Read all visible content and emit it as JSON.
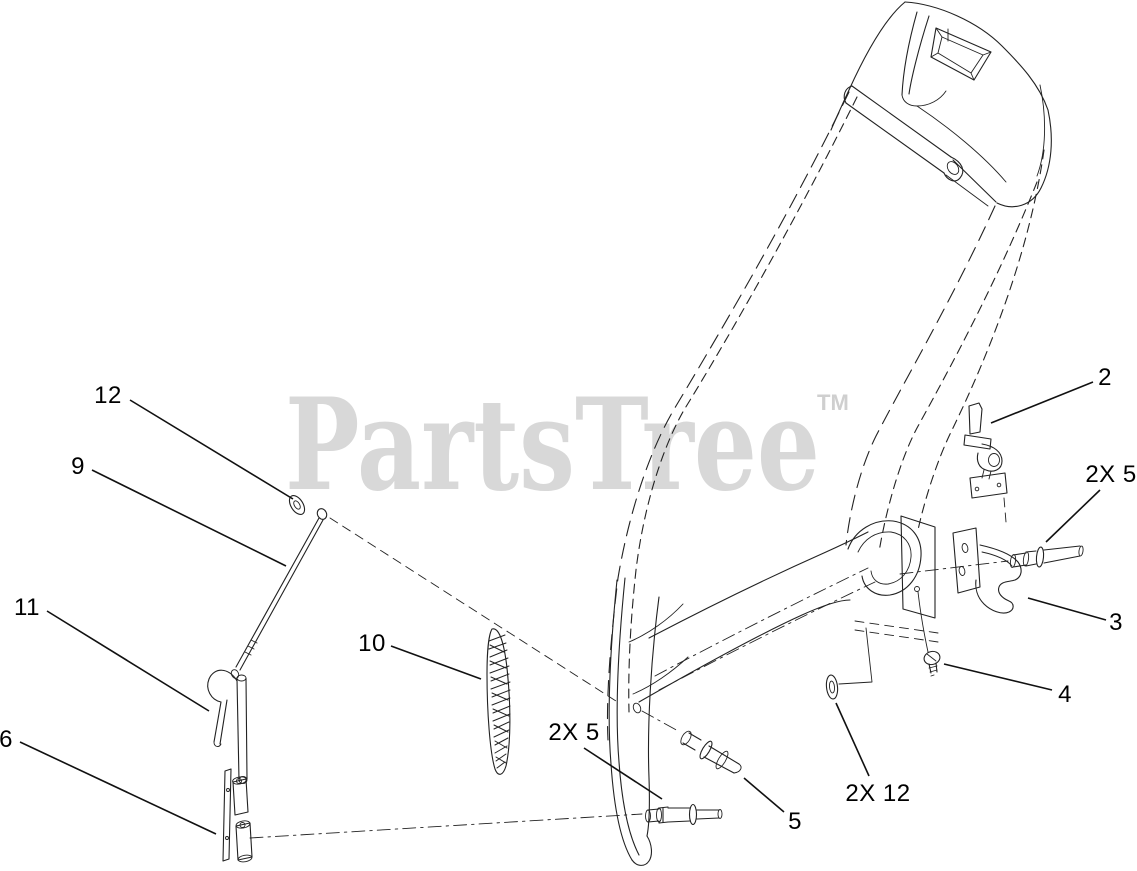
{
  "watermark": {
    "text": "PartsTree",
    "tm": "TM",
    "color": "#d8d8d8",
    "tm_color": "#cfcfcf"
  },
  "style": {
    "background": "#ffffff",
    "line_color": "#222222",
    "leader_color": "#111111"
  },
  "diagram_data": {
    "type": "exploded-parts-diagram",
    "callouts": [
      {
        "label": "12",
        "x": 108,
        "y": 396,
        "leader": [
          130,
          400,
          293,
          499
        ]
      },
      {
        "label": "9",
        "x": 78,
        "y": 467,
        "leader": [
          92,
          470,
          286,
          566
        ]
      },
      {
        "label": "11",
        "x": 27,
        "y": 608,
        "leader": [
          47,
          611,
          209,
          711
        ]
      },
      {
        "label": "6",
        "x": 6,
        "y": 740,
        "leader": [
          20,
          742,
          216,
          834
        ]
      },
      {
        "label": "10",
        "x": 372,
        "y": 644,
        "leader": [
          391,
          646,
          481,
          679
        ]
      },
      {
        "label": "2X 5",
        "x": 574,
        "y": 733,
        "leader": [
          584,
          748,
          662,
          799
        ]
      },
      {
        "label": "5",
        "x": 795,
        "y": 822,
        "leader": [
          784,
          812,
          744,
          778
        ]
      },
      {
        "label": "2",
        "x": 1105,
        "y": 378,
        "leader": [
          1093,
          382,
          991,
          423
        ]
      },
      {
        "label": "2X 5",
        "x": 1111,
        "y": 475,
        "leader": [
          1100,
          490,
          1046,
          542
        ]
      },
      {
        "label": "3",
        "x": 1116,
        "y": 623,
        "leader": [
          1106,
          620,
          1028,
          598
        ]
      },
      {
        "label": "4",
        "x": 1065,
        "y": 695,
        "leader": [
          1052,
          690,
          944,
          664
        ]
      },
      {
        "label": "2X 12",
        "x": 878,
        "y": 794,
        "leader": [
          869,
          776,
          836,
          703
        ]
      }
    ]
  }
}
